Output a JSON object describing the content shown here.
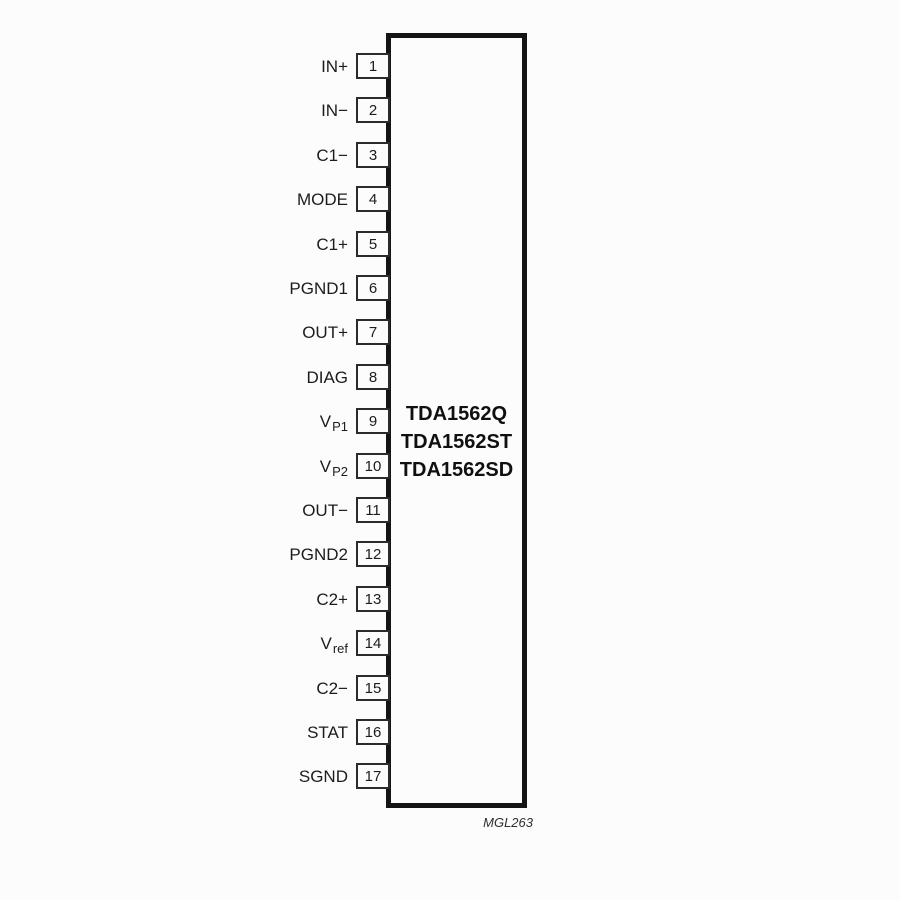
{
  "diagram": {
    "type": "ic-pinout",
    "part_numbers": [
      "TDA1562Q",
      "TDA1562ST",
      "TDA1562SD"
    ],
    "figure_code": "MGL263",
    "pin_count": 17,
    "colors": {
      "line": "#141414",
      "pin_box_border": "#2b2b2b",
      "text": "#1c1c1c",
      "background": "#fcfcfc"
    },
    "pins": [
      {
        "number": "1",
        "label": "IN+",
        "sub": ""
      },
      {
        "number": "2",
        "label": "IN−",
        "sub": ""
      },
      {
        "number": "3",
        "label": "C1−",
        "sub": ""
      },
      {
        "number": "4",
        "label": "MODE",
        "sub": ""
      },
      {
        "number": "5",
        "label": "C1+",
        "sub": ""
      },
      {
        "number": "6",
        "label": "PGND1",
        "sub": ""
      },
      {
        "number": "7",
        "label": "OUT+",
        "sub": ""
      },
      {
        "number": "8",
        "label": "DIAG",
        "sub": ""
      },
      {
        "number": "9",
        "label": "V",
        "sub": "P1"
      },
      {
        "number": "10",
        "label": "V",
        "sub": "P2"
      },
      {
        "number": "11",
        "label": "OUT−",
        "sub": ""
      },
      {
        "number": "12",
        "label": "PGND2",
        "sub": ""
      },
      {
        "number": "13",
        "label": "C2+",
        "sub": ""
      },
      {
        "number": "14",
        "label": "V",
        "sub": "ref"
      },
      {
        "number": "15",
        "label": "C2−",
        "sub": ""
      },
      {
        "number": "16",
        "label": "STAT",
        "sub": ""
      },
      {
        "number": "17",
        "label": "SGND",
        "sub": ""
      }
    ]
  }
}
